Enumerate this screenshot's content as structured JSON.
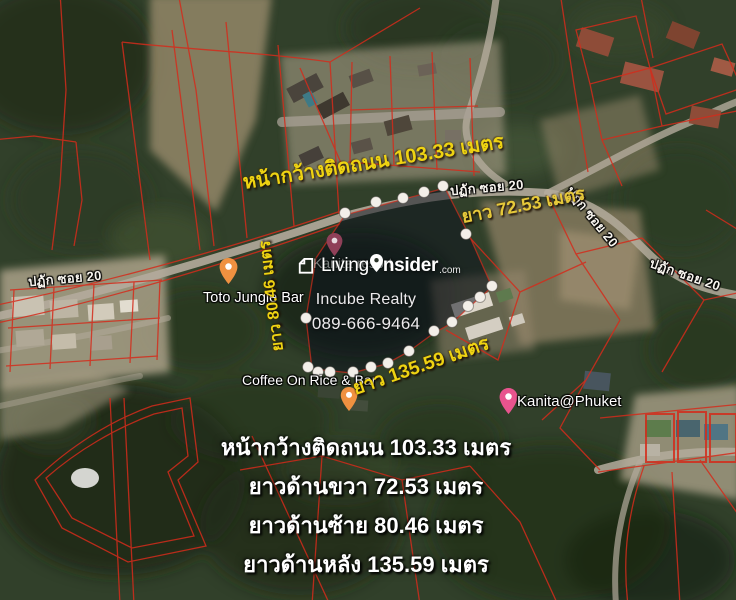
{
  "map_labels": {
    "road_name": "ปฏัก ซอย 20",
    "poi_toto": "Toto Jungle Bar",
    "poi_kanita_resort": "Kanita resort",
    "poi_coffee": "Coffee On Rice & Bar",
    "poi_kanita_phuket": "Kanita@Phuket"
  },
  "annotations": {
    "frontage": "หน้ากว้างติดถนน 103.33 เมตร",
    "side_right": "ยาว 72.53 เมตร",
    "side_left": "ยาว 80.46 เมตร",
    "side_back": "ยาว 135.59 เมตร"
  },
  "summary": {
    "lines": [
      "หน้ากว้างติดถนน 103.33 เมตร",
      "ยาวด้านขวา 72.53 เมตร",
      "ยาวด้านซ้าย 80.46 เมตร",
      "ยาวด้านหลัง 135.59 เมตร"
    ]
  },
  "watermark": {
    "brand_prefix": "Living",
    "brand_suffix": "nsider",
    "brand_tld": ".com",
    "agency": "Incube Realty",
    "phone": "089-666-9464"
  },
  "colors": {
    "parcel_line_red": "#d42c1c",
    "annotation_yellow": "#eed312",
    "plot_overlay": "rgba(12,18,28,0.52)",
    "pin_orange": "#ef9140",
    "pin_pink": "#e8548e",
    "pin_maroon": "#8f4058",
    "marker_dot": "#f3efe9"
  }
}
